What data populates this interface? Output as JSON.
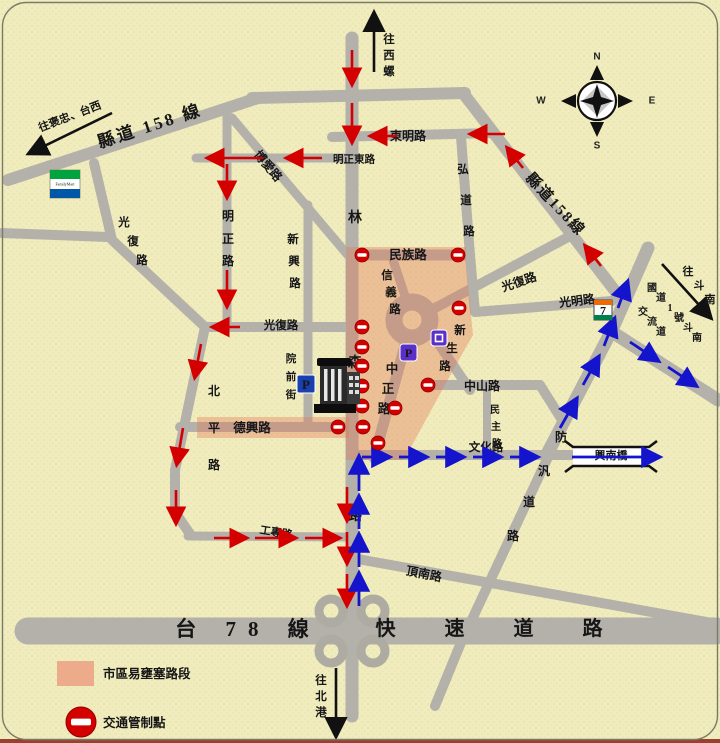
{
  "legend": {
    "congestion": "市區易壅塞路段",
    "control": "交通管制點"
  },
  "compass": {
    "n": "N",
    "e": "E",
    "s": "S",
    "w": "W"
  },
  "destinations": {
    "baozhong": "往褒忠、台西",
    "xiluo": "往西螺",
    "dounan": "往斗南",
    "guodao1": "國道1號斗南",
    "jiaoliudao": "交流道",
    "beigang": "往北港"
  },
  "roads": {
    "xiandao158_w": "縣道 158 線",
    "xiandao158_e": "縣道158線",
    "linsen": "林森路",
    "dongming": "東明路",
    "mingzheng_e": "明正東路",
    "mingzheng": "明正路",
    "boai": "博愛路",
    "xinxing": "新興路",
    "hongdao": "弘道路",
    "guangfu_nw": "光復路",
    "guangfu_mid": "光復路",
    "guangfu_ne": "光復路",
    "guangming": "光明路",
    "minzu": "民族路",
    "xinyi": "信義路",
    "zhongzheng": "中正路",
    "xinsheng": "新生路",
    "zhongshan": "中山路",
    "minzhu": "民主路",
    "wenhua": "文化路",
    "dexing": "德興路",
    "beiping": "北平路",
    "yuanqian": "院前街",
    "gongzhuan": "工專路",
    "dingnan": "頂南路",
    "fangxun": "防汎道路",
    "tai78": "台 78 線",
    "kuaisu": "快 速 道 路"
  },
  "landmarks": {
    "xingnan_bridge": "興南橋",
    "seven_eleven": "7",
    "familymart": "FamilyMart",
    "parking": "P"
  },
  "colors": {
    "background": "#f0ecbe",
    "road_gray": "#b4b1aa",
    "congestion_pink": "#e27a58",
    "control_red": "#d40000",
    "route_blue": "#1414cc"
  }
}
